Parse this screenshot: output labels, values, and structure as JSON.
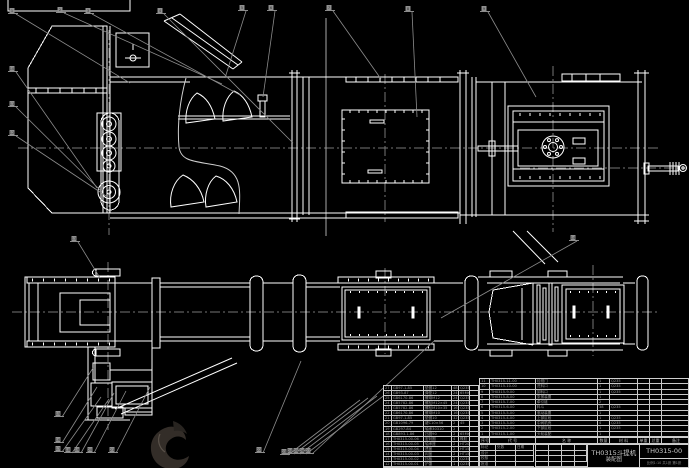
{
  "meta": {
    "kind": "CAD assembly drawing",
    "background": "#000000"
  },
  "colors": {
    "line": "#ffffff",
    "fine_line": "#d8d8d8",
    "leader": "#8c8c8c",
    "centerline": "#767676",
    "table_line": "#cfcfcf",
    "table_text": "#9a9a9a",
    "logo_dark": "#332d28",
    "logo_shadow": "#282420",
    "logo_highlight": "#5a524a"
  },
  "title_block": {
    "product": "TH0315斗提机",
    "doc_type": "装配图",
    "drawing_no": "TH0315-00",
    "footer_note": "比例1:10 共1张 第1张",
    "revision_rows": [
      [
        "标记",
        "处数",
        "日期"
      ],
      [
        "设计",
        "",
        ""
      ],
      [
        "校核",
        "",
        ""
      ],
      [
        "批准",
        "",
        ""
      ]
    ],
    "signature_grid": {
      "rows": 4,
      "cols": 4
    }
  },
  "right_bom": {
    "headers": [
      "序号",
      "代 号",
      "名 称",
      "数量",
      "材 料",
      "单重",
      "总重",
      "备注"
    ],
    "col_widths": [
      10,
      46,
      62,
      12,
      28,
      12,
      12,
      28
    ],
    "rows": [
      [
        "11",
        "TH0315-11-00",
        "检视门",
        "1",
        "Q235",
        "",
        "",
        ""
      ],
      [
        "10",
        "TH0315-10-00",
        "进料口",
        "1",
        "Q235",
        "",
        "",
        ""
      ],
      [
        "9",
        "TH0315-9-00",
        "卸料口",
        "1",
        "Q235",
        "",
        "",
        ""
      ],
      [
        "8",
        "TH0315-8-00",
        "张紧装置",
        "1",
        "",
        "",
        "",
        ""
      ],
      [
        "7",
        "TH0315-7-00",
        "牵引链",
        "2",
        "",
        "",
        "",
        ""
      ],
      [
        "6",
        "TH0315-6-00",
        "料斗",
        "38",
        "Q235",
        "",
        "",
        ""
      ],
      [
        "5",
        "TH0315-5-00",
        "驱动装置",
        "1",
        "",
        "",
        "",
        ""
      ],
      [
        "4",
        "TH0315-4-00",
        "上部区段",
        "1",
        "Q235",
        "",
        "",
        ""
      ],
      [
        "3",
        "TH0315-3-00",
        "中间机壳",
        "4",
        "Q235",
        "",
        "",
        ""
      ],
      [
        "2",
        "TH0315-2-00",
        "下部区段",
        "1",
        "Q235",
        "",
        "",
        ""
      ],
      [
        "1",
        "TH0315-1-00",
        "头轮装配",
        "1",
        "",
        "",
        "",
        ""
      ]
    ]
  },
  "left_bom": {
    "col_widths": [
      8,
      32,
      28,
      7,
      11,
      10
    ],
    "rows": [
      [
        "27",
        "GB97.1-85",
        "垫圈12",
        "48",
        "Q235",
        ""
      ],
      [
        "26",
        "GB93-87",
        "弹垫12",
        "24",
        "65Mn",
        ""
      ],
      [
        "25",
        "GB6170-86",
        "螺母M12",
        "24",
        "Q235",
        ""
      ],
      [
        "24",
        "GB5782-86",
        "螺栓M12×45",
        "24",
        "Q235",
        ""
      ],
      [
        "23",
        "GB5782-86",
        "螺栓M10×35",
        "16",
        "Q235",
        ""
      ],
      [
        "22",
        "GB6170-86",
        "螺母M10",
        "16",
        "Q235",
        ""
      ],
      [
        "21",
        "GB97.1-85",
        "垫圈10",
        "32",
        "Q235",
        ""
      ],
      [
        "20",
        "GB1096-79",
        "键C10×56",
        "2",
        "45",
        ""
      ],
      [
        "19",
        "GB297-84",
        "轴承30310",
        "2",
        "",
        ""
      ],
      [
        "18",
        "GB893.1-86",
        "挡圈90",
        "2",
        "65Mn",
        ""
      ],
      [
        "17",
        "TH0315-00-06",
        "密封圈",
        "4",
        "橡胶",
        ""
      ],
      [
        "16",
        "TH0315-00-05",
        "轴承座",
        "2",
        "HT200",
        ""
      ],
      [
        "15",
        "TH0315-00-04",
        "透盖",
        "2",
        "HT150",
        ""
      ],
      [
        "14",
        "TH0315-00-03",
        "闷盖",
        "2",
        "HT150",
        ""
      ],
      [
        "13",
        "TH0315-00-02",
        "挡板",
        "2",
        "Q235",
        ""
      ],
      [
        "12",
        "TH0315-00-01",
        "护罩",
        "1",
        "Q235",
        ""
      ]
    ]
  },
  "balloons": [
    {
      "n": "1",
      "x": 12,
      "y": 10,
      "tx": 130,
      "ty": 83
    },
    {
      "n": "2",
      "x": 60,
      "y": 9,
      "tx": 222,
      "ty": 84
    },
    {
      "n": "3",
      "x": 88,
      "y": 10,
      "tx": 240,
      "ty": 95
    },
    {
      "n": "4",
      "x": 160,
      "y": 10,
      "tx": 293,
      "ty": 143
    },
    {
      "n": "5",
      "x": 242,
      "y": 7,
      "tx": 225,
      "ty": 78
    },
    {
      "n": "6",
      "x": 271,
      "y": 7,
      "tx": 263,
      "ty": 97
    },
    {
      "n": "7",
      "x": 329,
      "y": 7,
      "tx": 381,
      "ty": 79
    },
    {
      "n": "8",
      "x": 408,
      "y": 8,
      "tx": 417,
      "ty": 117
    },
    {
      "n": "9",
      "x": 484,
      "y": 8,
      "tx": 536,
      "ty": 97
    },
    {
      "n": "10",
      "x": 12,
      "y": 68,
      "tx": 97,
      "ty": 188
    },
    {
      "n": "11",
      "x": 12,
      "y": 103,
      "tx": 102,
      "ty": 192
    },
    {
      "n": "12",
      "x": 12,
      "y": 132,
      "tx": 106,
      "ty": 196
    },
    {
      "n": "13",
      "x": 74,
      "y": 238,
      "tx": 100,
      "ty": 278
    },
    {
      "n": "14",
      "x": 573,
      "y": 237,
      "tx": 441,
      "ty": 318
    },
    {
      "n": "15",
      "x": 58,
      "y": 413,
      "tx": 93,
      "ty": 368
    },
    {
      "n": "16",
      "x": 58,
      "y": 439,
      "tx": 97,
      "ty": 387
    },
    {
      "n": "17",
      "x": 58,
      "y": 448,
      "tx": 101,
      "ty": 397
    },
    {
      "n": "18",
      "x": 68,
      "y": 449,
      "tx": 109,
      "ty": 399
    },
    {
      "n": "19",
      "x": 77,
      "y": 449,
      "tx": 114,
      "ty": 393
    },
    {
      "n": "20",
      "x": 90,
      "y": 449,
      "tx": 126,
      "ty": 391
    },
    {
      "n": "21",
      "x": 112,
      "y": 449,
      "tx": 150,
      "ty": 387
    },
    {
      "n": "22",
      "x": 259,
      "y": 449,
      "tx": 301,
      "ty": 361
    },
    {
      "n": "23",
      "x": 284,
      "y": 451,
      "tx": 360,
      "ty": 400
    },
    {
      "n": "24",
      "x": 290,
      "y": 450,
      "tx": 368,
      "ty": 398
    },
    {
      "n": "25",
      "x": 296,
      "y": 450,
      "tx": 377,
      "ty": 396
    },
    {
      "n": "26",
      "x": 302,
      "y": 450,
      "tx": 386,
      "ty": 394
    },
    {
      "n": "27",
      "x": 308,
      "y": 450,
      "tx": 434,
      "ty": 341
    }
  ]
}
